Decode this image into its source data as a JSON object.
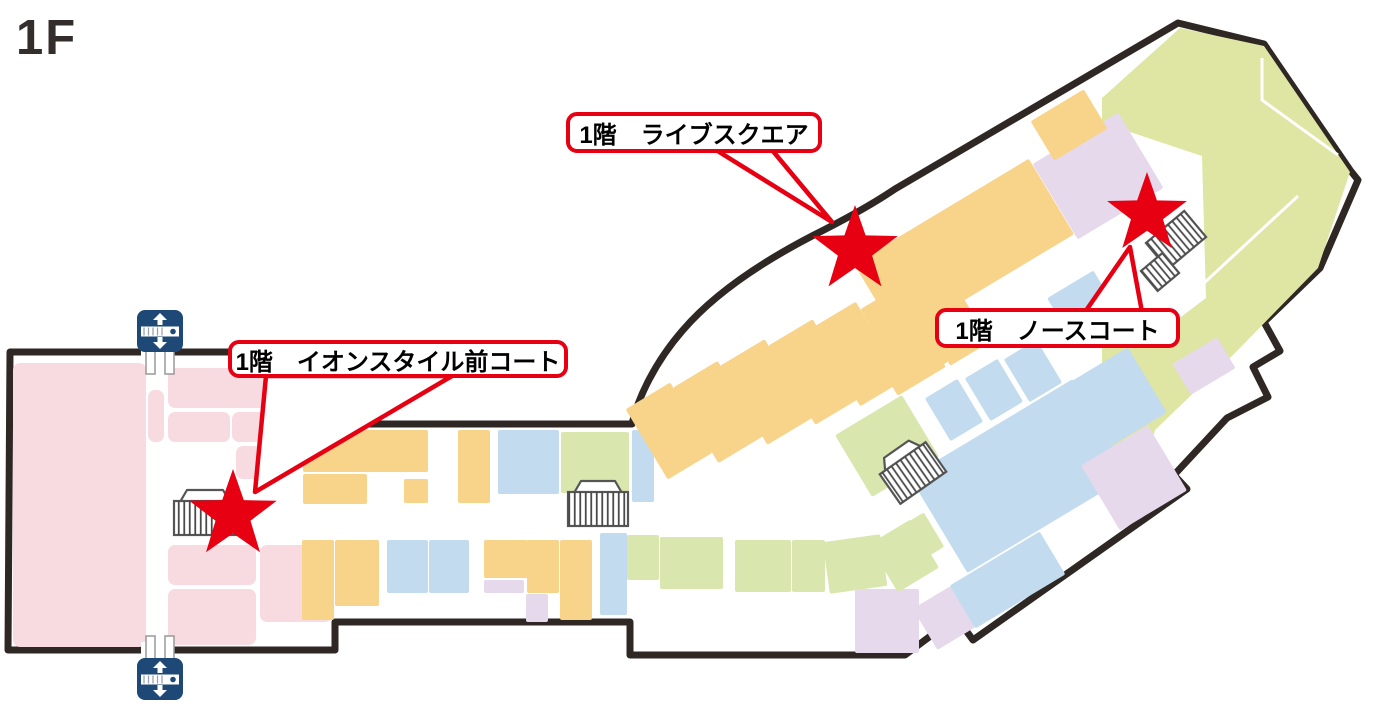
{
  "page": {
    "floor_label": "1F",
    "background": "#FFFFFF"
  },
  "palette": {
    "outline": "#2e2724",
    "star_red": "#e60012",
    "callout_border": "#e60012",
    "callout_text": "#000000",
    "pink": "#f8dbe1",
    "orange": "#f8d38a",
    "blue": "#c3dbee",
    "green": "#d9e6ae",
    "big_green": "#dfe5a3",
    "purple": "#e7d9ec",
    "icon_navy": "#1e4976",
    "icon_gray": "#555555"
  },
  "map": {
    "outline_path": "M 10 352 L 273 352 L 273 424 L 632 424 C 638 398 655 362 683 330 C 714 294 762 262 812 236 C 840 222 870 206 895 189 L 1178 23 L 1264 44 L 1350 170 L 1358 180 L 1320 268 L 1264 322 L 1280 351 L 1253 367 L 1268 397 L 1227 418 L 1174 475 L 1187 489 L 973 640 L 956 617 L 905 655 L 630 655 L 630 622 L 335 622 L 335 650 L 8 650 Z",
    "wall_gaps": [
      {
        "x": 141,
        "y": 344,
        "w": 30,
        "h": 16
      },
      {
        "x": 141,
        "y": 642,
        "w": 30,
        "h": 16
      }
    ],
    "green_area_points": "1102,98 1180,28 1264,46 1350,172 1318,268 1232,356 1155,430 1146,464 1114,470 1102,380",
    "court_cutout_points": "1036,212 1112,126 1202,156 1206,298 1148,342 1066,308",
    "white_lines": [
      "M1262,58 L1262,100 L1338,155",
      "M1136,346 L1298,196",
      "M1096,136 L1128,216"
    ],
    "block_fields": "x,y,w,h,color,rot",
    "blocks": [
      [
        13,
        363,
        133,
        284,
        "pink",
        0
      ],
      [
        168,
        368,
        110,
        40,
        "pink",
        0
      ],
      [
        168,
        412,
        62,
        30,
        "pink",
        0
      ],
      [
        232,
        412,
        46,
        30,
        "pink",
        0
      ],
      [
        236,
        446,
        46,
        33,
        "pink",
        0
      ],
      [
        148,
        390,
        16,
        52,
        "pink",
        0
      ],
      [
        168,
        545,
        88,
        40,
        "pink",
        0
      ],
      [
        168,
        589,
        88,
        56,
        "pink",
        0
      ],
      [
        260,
        545,
        72,
        77,
        "pink",
        0
      ],
      [
        303,
        430,
        125,
        42,
        "orange",
        0
      ],
      [
        303,
        474,
        64,
        30,
        "orange",
        0
      ],
      [
        404,
        479,
        24,
        24,
        "orange",
        0
      ],
      [
        458,
        430,
        32,
        73,
        "orange",
        0
      ],
      [
        498,
        430,
        61,
        64,
        "blue",
        0
      ],
      [
        561,
        432,
        68,
        61,
        "green",
        0
      ],
      [
        632,
        430,
        22,
        72,
        "blue",
        0
      ],
      [
        302,
        540,
        32,
        80,
        "orange",
        0
      ],
      [
        335,
        540,
        44,
        66,
        "orange",
        0
      ],
      [
        387,
        540,
        41,
        53,
        "blue",
        0
      ],
      [
        429,
        540,
        40,
        53,
        "blue",
        0
      ],
      [
        484,
        540,
        44,
        38,
        "orange",
        0
      ],
      [
        484,
        580,
        40,
        13,
        "purple",
        0
      ],
      [
        527,
        540,
        32,
        53,
        "orange",
        0
      ],
      [
        526,
        594,
        22,
        28,
        "purple",
        0
      ],
      [
        560,
        540,
        32,
        80,
        "orange",
        0
      ],
      [
        600,
        533,
        27,
        82,
        "blue",
        0
      ],
      [
        627,
        535,
        32,
        45,
        "green",
        0
      ],
      [
        660,
        537,
        63,
        52,
        "green",
        0
      ],
      [
        735,
        540,
        56,
        52,
        "green",
        0
      ],
      [
        792,
        540,
        33,
        52,
        "green",
        0
      ],
      [
        826,
        538,
        58,
        52,
        "green",
        -8
      ],
      [
        882,
        524,
        56,
        40,
        "green",
        -31
      ],
      [
        855,
        589,
        64,
        64,
        "purple",
        0
      ],
      [
        922,
        594,
        44,
        48,
        "purple",
        -31
      ],
      [
        650,
        406,
        32,
        24,
        "pink",
        -20
      ],
      [
        643,
        390,
        52,
        82,
        "orange",
        -31
      ],
      [
        692,
        368,
        52,
        88,
        "orange",
        -31
      ],
      [
        740,
        346,
        52,
        92,
        "orange",
        -31
      ],
      [
        788,
        326,
        52,
        92,
        "orange",
        -31
      ],
      [
        833,
        308,
        50,
        92,
        "orange",
        -31
      ],
      [
        880,
        290,
        50,
        90,
        "orange",
        -31
      ],
      [
        925,
        274,
        46,
        86,
        "orange",
        -31
      ],
      [
        850,
        330,
        38,
        58,
        "orange",
        -31
      ],
      [
        884,
        346,
        56,
        38,
        "orange",
        -31
      ],
      [
        862,
        205,
        204,
        88,
        "orange",
        -31
      ],
      [
        1048,
        132,
        100,
        88,
        "purple",
        -31
      ],
      [
        1038,
        102,
        62,
        46,
        "orange",
        -31
      ],
      [
        935,
        385,
        38,
        50,
        "blue",
        -31
      ],
      [
        975,
        365,
        38,
        50,
        "blue",
        -31
      ],
      [
        1014,
        346,
        38,
        50,
        "blue",
        -31
      ],
      [
        925,
        420,
        190,
        112,
        "blue",
        -31
      ],
      [
        1075,
        362,
        78,
        76,
        "blue",
        -31
      ],
      [
        1095,
        440,
        78,
        76,
        "purple",
        -31
      ],
      [
        1178,
        348,
        52,
        36,
        "purple",
        -31
      ],
      [
        848,
        410,
        78,
        72,
        "green",
        -31
      ],
      [
        880,
        528,
        48,
        56,
        "green",
        -31
      ],
      [
        955,
        555,
        105,
        50,
        "blue",
        -31
      ],
      [
        1052,
        282,
        54,
        34,
        "blue",
        -31
      ]
    ],
    "stairs_icons": [
      {
        "cx": 205,
        "cy": 518,
        "w": 62,
        "h": 34,
        "rot": 0,
        "canopy": true
      },
      {
        "cx": 598,
        "cy": 509,
        "w": 60,
        "h": 34,
        "rot": 0,
        "canopy": true
      },
      {
        "cx": 913,
        "cy": 473,
        "w": 56,
        "h": 36,
        "rot": -35,
        "canopy": true
      },
      {
        "cx": 1176,
        "cy": 240,
        "w": 50,
        "h": 34,
        "rot": -40,
        "canopy": false
      },
      {
        "cx": 1160,
        "cy": 272,
        "w": 28,
        "h": 26,
        "rot": -40,
        "canopy": false
      }
    ],
    "escalator_icons": [
      {
        "cx": 160,
        "cy": 331,
        "legs": "down"
      },
      {
        "cx": 160,
        "cy": 679,
        "legs": "up"
      }
    ],
    "stars": [
      {
        "id": "aeon-style-court",
        "cx": 233,
        "cy": 515,
        "r": 46
      },
      {
        "id": "live-square",
        "cx": 855,
        "cy": 250,
        "r": 45
      },
      {
        "id": "north-court",
        "cx": 1147,
        "cy": 214,
        "r": 42
      }
    ],
    "callouts": [
      {
        "id": "live-square",
        "text": "1階　ライブスクエア",
        "box": {
          "x": 566,
          "y": 112,
          "w": 256,
          "h": 41
        },
        "pointer": "716,150 772,150 832,222"
      },
      {
        "id": "north-court",
        "text": "1階　ノースコート",
        "box": {
          "x": 935,
          "y": 308,
          "w": 245,
          "h": 40
        },
        "pointer": "1085,312 1142,312 1130,247"
      },
      {
        "id": "aeon-style-court",
        "text": "1階　イオンスタイル前コート",
        "box": {
          "x": 228,
          "y": 340,
          "w": 340,
          "h": 38
        },
        "pointer": "266,376 452,376 255,492"
      }
    ]
  }
}
